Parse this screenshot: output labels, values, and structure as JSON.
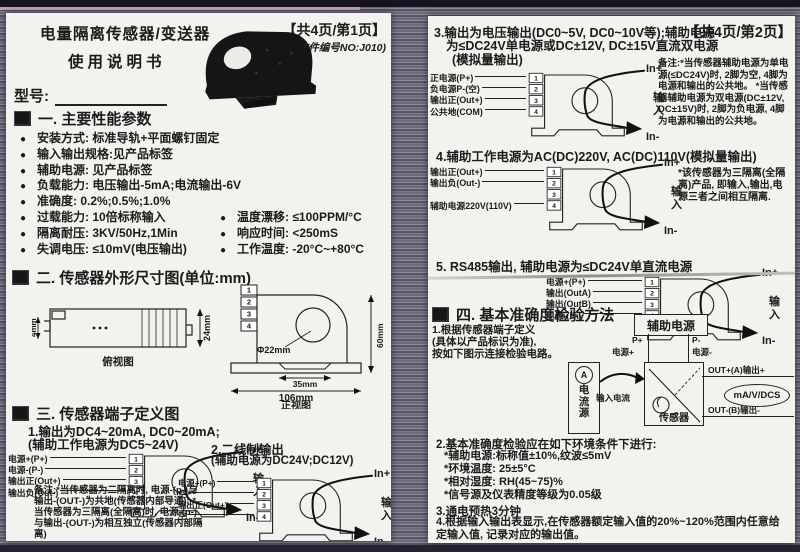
{
  "shared": {
    "bullet": "●",
    "pins": [
      "1",
      "2",
      "3",
      "4"
    ],
    "in_plus": "In+",
    "input_label": "输入",
    "in_minus": "In-"
  },
  "page1": {
    "title_line1": "电量隔离传感器/变送器",
    "title_line2": "使用说明书",
    "page_info": "【共4页/第1页】",
    "doc_no": "(文件编号NO:J010)",
    "model_label": "型号:",
    "section1": {
      "heading": "一. 主要性能参数",
      "rows": [
        {
          "c1": "安装方式: 标准导轨+平面螺钉固定",
          "c2": ""
        },
        {
          "c1": "输入输出规格:见产品标签",
          "c2": ""
        },
        {
          "c1": "辅助电源: 见产品标签",
          "c2": ""
        },
        {
          "c1": "负载能力: 电压输出-5mA;电流输出-6V",
          "c2": ""
        },
        {
          "c1": "准确度: 0.2%;0.5%;1.0%",
          "c2": ""
        },
        {
          "c1": "过载能力: 10倍标称输入",
          "c2": "温度漂移: ≤100PPM/°C"
        },
        {
          "c1": "隔离耐压: 3KV/50Hz,1Min",
          "c2": "响应时间: <250mS"
        },
        {
          "c1": "失调电压: ≤10mV(电压输出)",
          "c2": "工作温度: -20°C~+80°C"
        }
      ]
    },
    "section2": {
      "heading": "二. 传感器外形尺寸图(单位:mm)",
      "side_view": {
        "dim_left": "4mm",
        "dim_right": "24mm",
        "caption": "俯视图"
      },
      "front_view": {
        "hole": "Φ22mm",
        "dim_inner": "35mm",
        "dim_width": "106mm",
        "dim_height": "60mm",
        "caption": "正视图"
      }
    },
    "section3": {
      "heading": "三. 传感器端子定义图",
      "d1_title": "1.输出为DC4~20mA, DC0~20mA;",
      "d1_subtitle": "(辅助工作电源为DC5~24V)",
      "d1_terminals": [
        "电源+(P+)",
        "电源-(P-)",
        "输出正(Out+)",
        "输出负(Out-)"
      ],
      "d1_note": "备注:*当传感器为二隔离时, 电源-(p-)与输出-(OUT-)为共地(传感器内部导通);  *当传感器为三隔离(全隔离)时, 电源-(p-)与输出-(OUT-)为相互独立(传感器内部隔离)",
      "d2_title": "2.二线制输出",
      "d2_subtitle": "(辅助电源为DC24V;DC12V)",
      "d2_terminals": [
        "电源+(P+)",
        "空",
        "输出正(Out+)",
        "空"
      ]
    }
  },
  "page2": {
    "page_info": "【共4页/第2页】",
    "s3": {
      "title_lines": [
        "3.输出为电压输出(DC0~5V, DC0~10V等);辅助电源",
        "为≤DC24V单电源或DC±12V, DC±15V直流双电源",
        "(模拟量输出)"
      ],
      "terminals": [
        "正电源(P+)",
        "负电源P-(空)",
        "输出正(Out+)",
        "公共地(COM)"
      ],
      "note": "备注:*当传感器辅助电源为单电源(≤DC24V)时, 2脚为空, 4脚为电源和输出的公共地。  *当传感器辅助电源为双电源(DC±12V, DC±15V)时, 2脚为负电源, 4脚为电源和输出的公共地。"
    },
    "s4": {
      "title": "4.辅助工作电源为AC(DC)220V, AC(DC)110V(模拟量输出)",
      "terminals": [
        "输出正(Out+)",
        "输出负(Out-)",
        "辅助电源220V(110V)"
      ],
      "note": "*该传感器为三隔离(全隔离)产品, 即输入,输出,电源三者之间相互隔离."
    },
    "s5": {
      "title": "5. RS485输出, 辅助电源为≤DC24V单直流电源",
      "terminals": [
        "电源+(P+)",
        "输出(OutA)",
        "输出(OutB)",
        "电源-(P-)"
      ]
    },
    "s6": {
      "heading": "四. 基本准确度检验方法",
      "item1_lines": [
        "1.根据传感器端子定义",
        "(具体以产品标识为准),",
        "按如下图示连接检验电路。"
      ],
      "circuit": {
        "aux": "辅助电源",
        "p_plus": "P+",
        "p_plus_sub": "电源+",
        "p_minus": "P-",
        "p_minus_sub": "电源-",
        "ammeter": "A",
        "source": "电流源",
        "input_current": "输入电流",
        "sensor": "传感器",
        "out_plus": "OUT+(A)输出+",
        "out_minus": "OUT-(B)输出-",
        "meter": "mA/V/DCS"
      },
      "item2": "2.基本准确度检验应在如下环境条件下进行:",
      "item2_subs": [
        "*辅助电源:标称值±10%,纹波≤5mV",
        "*环境温度: 25±5°C",
        "*相对湿度: RH(45~75)%",
        "*信号源及仪表精度等级为0.05级"
      ],
      "item3": "3.通电预热3分钟",
      "item4": "4.根据输入输出表显示,在传感器额定输入值的20%~120%范围内任意给定输入值, 记录对应的输出值。"
    }
  }
}
